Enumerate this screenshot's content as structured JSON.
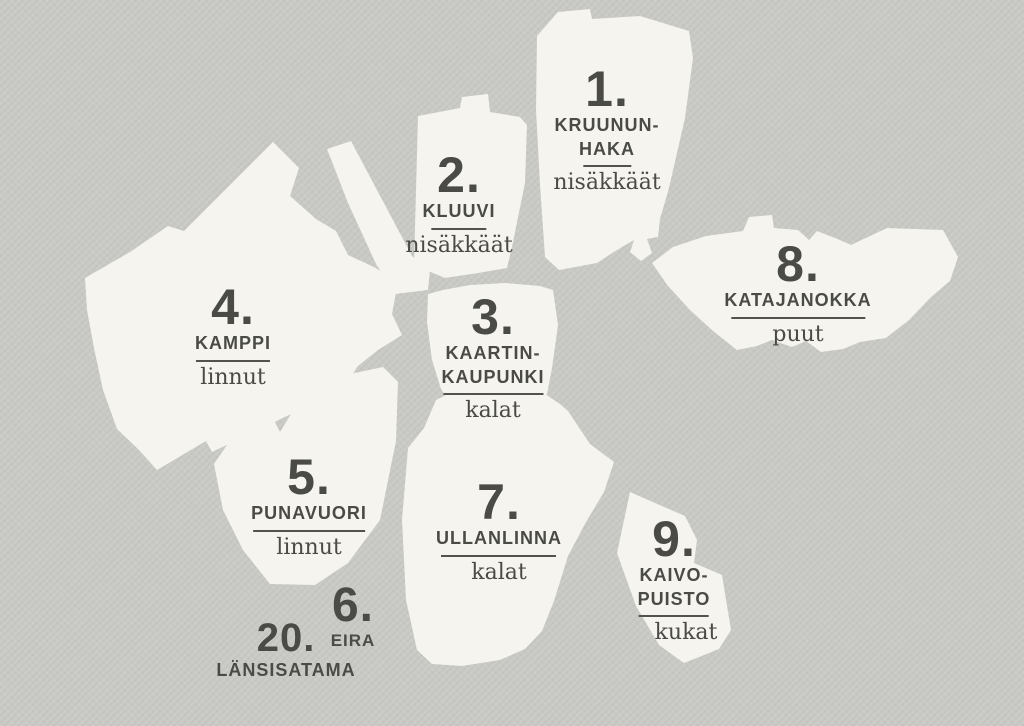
{
  "colors": {
    "background": "#c9cac5",
    "shape": "#f5f4ee",
    "text": "#4a4a47",
    "rule": "#53534e"
  },
  "regions": [
    {
      "id": "kruununhaka",
      "number": "1.",
      "line1": "KRUUNUN-",
      "line2": "HAKA",
      "category": "nisäkkäät"
    },
    {
      "id": "kluuvi",
      "number": "2.",
      "line1": "KLUUVI",
      "line2": "",
      "category": "nisäkkäät"
    },
    {
      "id": "kaartinkaupunki",
      "number": "3.",
      "line1": "KAARTIN-",
      "line2": "KAUPUNKI",
      "category": "kalat"
    },
    {
      "id": "kamppi",
      "number": "4.",
      "line1": "KAMPPI",
      "line2": "",
      "category": "linnut"
    },
    {
      "id": "punavuori",
      "number": "5.",
      "line1": "PUNAVUORI",
      "line2": "",
      "category": "linnut"
    },
    {
      "id": "eira",
      "number": "6.",
      "line1": "EIRA",
      "line2": "",
      "category": ""
    },
    {
      "id": "ullanlinna",
      "number": "7.",
      "line1": "ULLANLINNA",
      "line2": "",
      "category": "kalat"
    },
    {
      "id": "katajanokka",
      "number": "8.",
      "line1": "KATAJANOKKA",
      "line2": "",
      "category": "puut"
    },
    {
      "id": "kaivopuisto",
      "number": "9.",
      "line1": "KAIVO-",
      "line2": "PUISTO",
      "category": "kukat"
    },
    {
      "id": "lansisatama",
      "number": "20.",
      "line1": "LÄNSISATAMA",
      "line2": "",
      "category": ""
    }
  ]
}
